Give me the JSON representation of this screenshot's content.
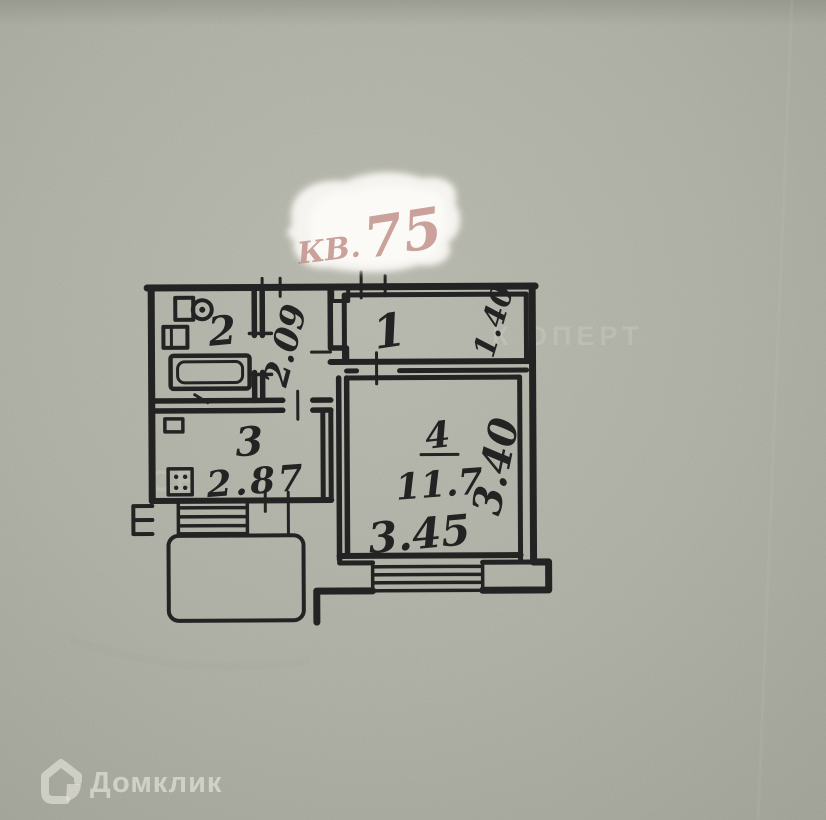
{
  "stamp": {
    "prefix": "КВ.",
    "number": "75"
  },
  "plan": {
    "room1": {
      "label": "1",
      "dim": "1.40"
    },
    "room2": {
      "label": "2"
    },
    "corridor": {
      "dim": "2.09"
    },
    "room3": {
      "label": "3",
      "dim": "2.87"
    },
    "room4": {
      "label": "4",
      "area": "11.7",
      "dim_bottom": "3.45",
      "dim_side": "3.40"
    }
  },
  "watermark": {
    "logo_text": "Домклик",
    "fragment_right": "К ОПЕРТ",
    "fragment_left": "СЕ"
  },
  "colors": {
    "paper": "#b0b1a6",
    "ink": "#232323",
    "stamp_ink": "#c2928c",
    "patch": "#f8f6f2"
  }
}
